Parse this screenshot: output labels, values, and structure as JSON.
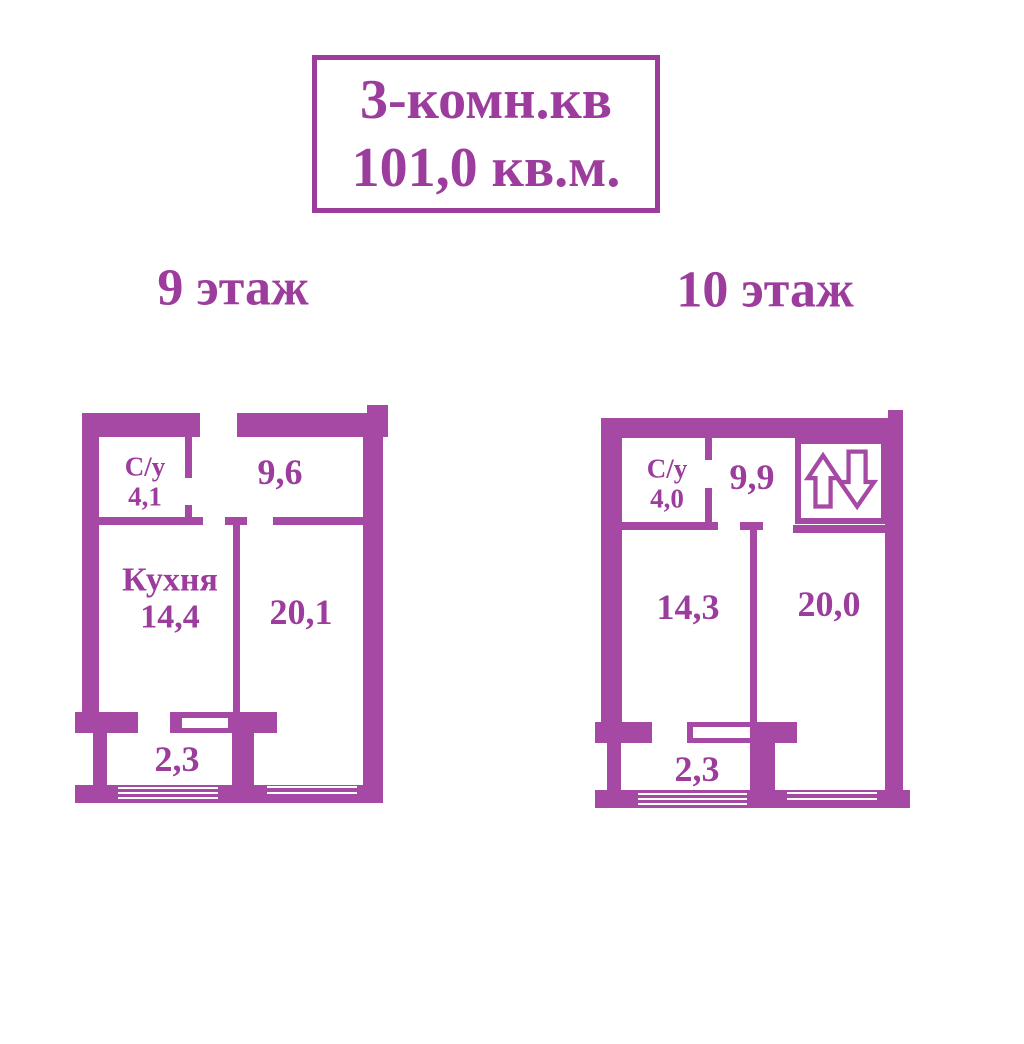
{
  "colors": {
    "wall": "#A549A5",
    "text": "#9C3C9C",
    "background": "#FFFFFF"
  },
  "title": {
    "line1": "3-комн.кв",
    "line2": "101,0 кв.м."
  },
  "floors": [
    {
      "label": "9 этаж",
      "rooms": {
        "bathroom_name": "С/у",
        "bathroom_area": "4,1",
        "hall_area": "9,6",
        "kitchen_name": "Кухня",
        "kitchen_area": "14,4",
        "living_area": "20,1",
        "balcony_area": "2,3"
      }
    },
    {
      "label": "10 этаж",
      "rooms": {
        "bathroom_name": "С/у",
        "bathroom_area": "4,0",
        "hall_area": "9,9",
        "left_room_area": "14,3",
        "right_room_area": "20,0",
        "balcony_area": "2,3"
      }
    }
  ],
  "icons": {
    "stairs_up_down": "лестница вверх/вниз"
  }
}
